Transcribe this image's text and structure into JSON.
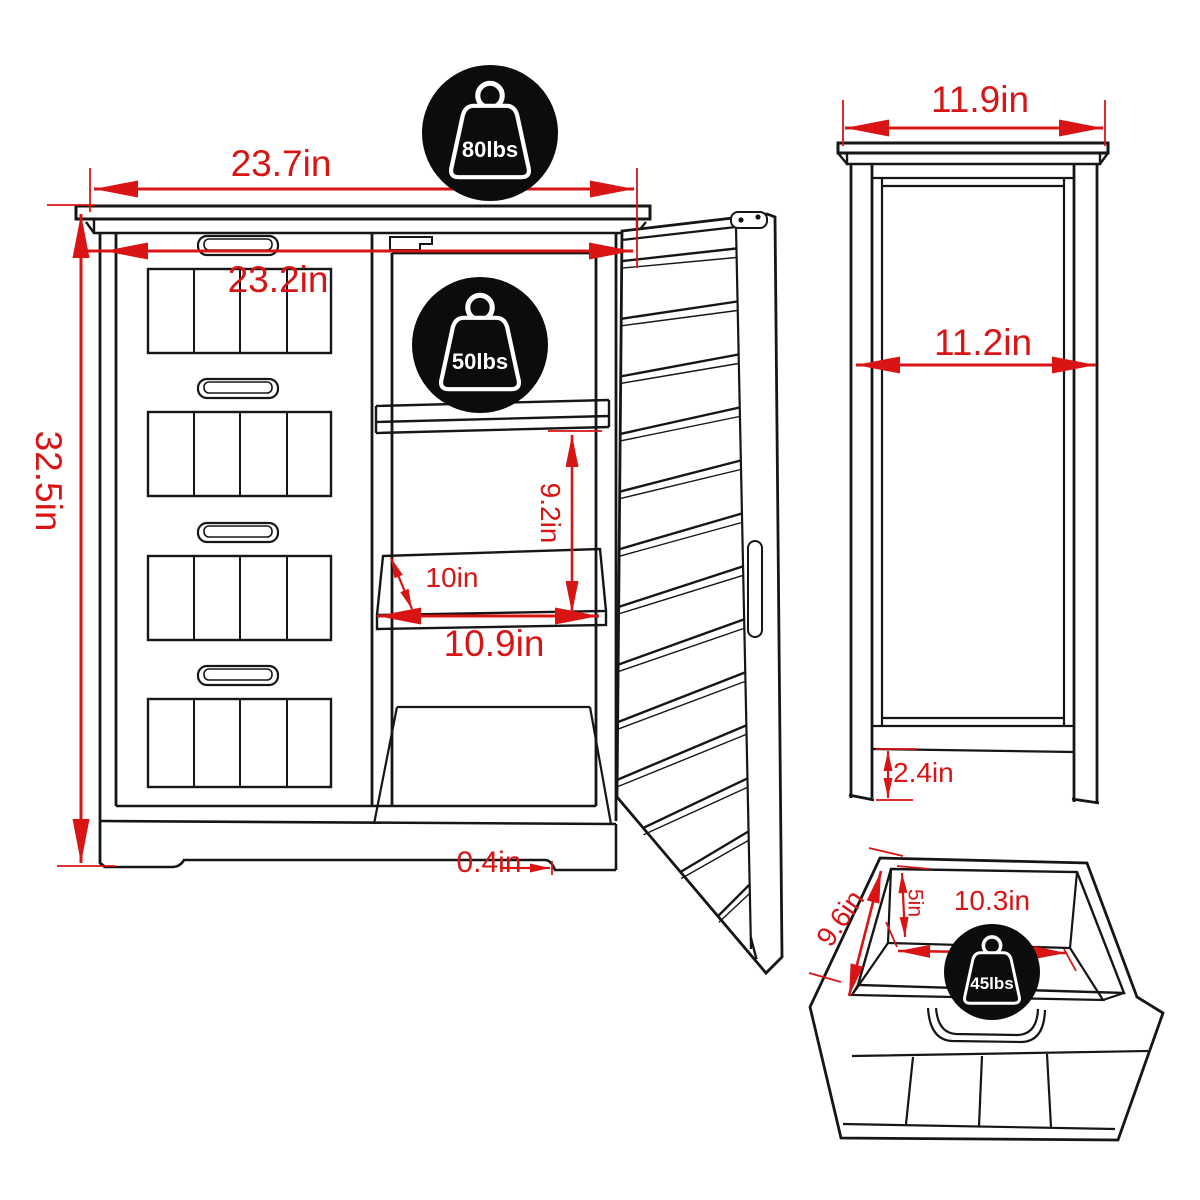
{
  "diagram_title": "cabinet-dimension-diagram",
  "front_view": {
    "width_top": "23.7in",
    "width_inner": "23.2in",
    "height": "32.5in",
    "shelf_section_height": "9.2in",
    "shelf_depth": "10in",
    "shelf_width": "10.9in",
    "base_height": "0.4in",
    "top_capacity": "80lbs",
    "shelf_capacity": "50lbs"
  },
  "side_view": {
    "depth_top": "11.9in",
    "depth_inner": "11.2in",
    "leg_height": "2.4in"
  },
  "drawer_view": {
    "inner_depth": "9.6in",
    "inner_height": "5in",
    "inner_width": "10.3in",
    "capacity": "45lbs"
  },
  "colors": {
    "dimension_red": "#d81414",
    "line_black": "#161616",
    "badge_black": "#0c0c0c",
    "background": "#ffffff"
  }
}
